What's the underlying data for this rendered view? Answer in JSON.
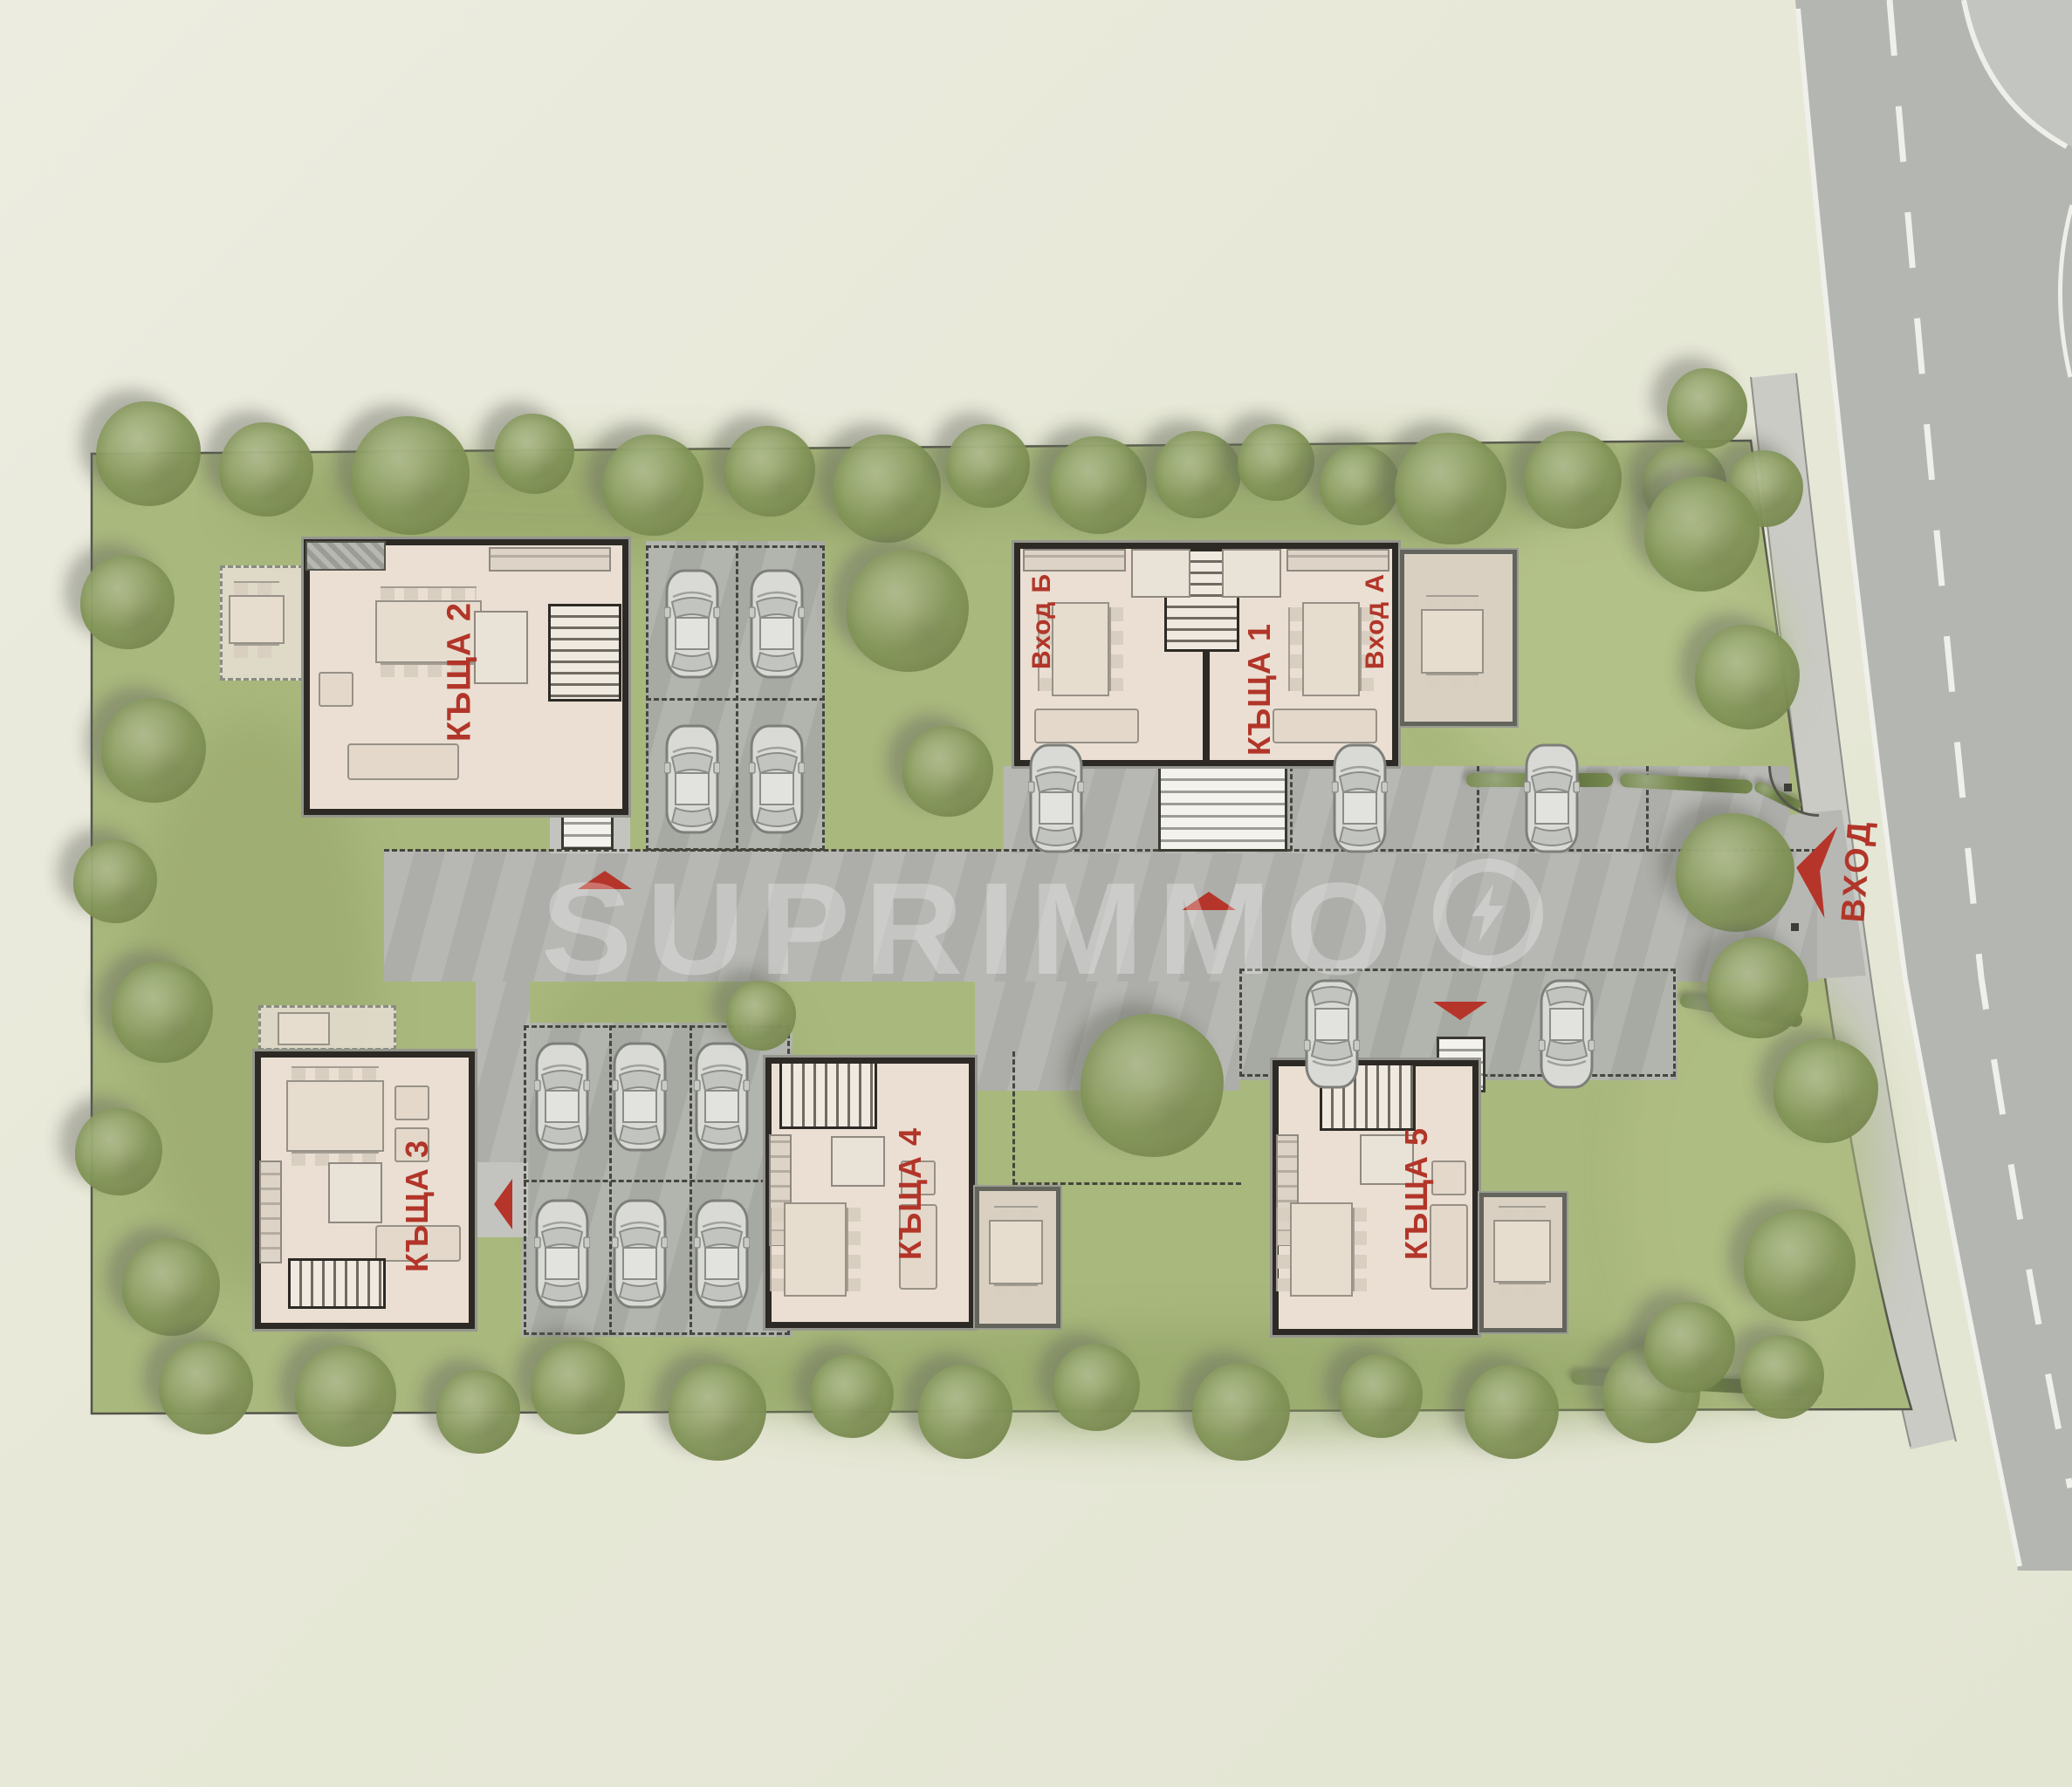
{
  "watermark": {
    "text": "SUPRIMMO"
  },
  "entrance": {
    "label": "ВХОД"
  },
  "houses": {
    "house1": {
      "label": "КЪЩА 1",
      "entrance_a": {
        "label": "Вход А"
      },
      "entrance_b": {
        "label": "Вход Б"
      }
    },
    "house2": {
      "label": "КЪЩА 2"
    },
    "house3": {
      "label": "КЪЩА 3"
    },
    "house4": {
      "label": "КЪЩА 4"
    },
    "house5": {
      "label": "КЪЩА 5"
    }
  },
  "colors": {
    "accent_red": "#b5352a",
    "grass_green": "#a9b87d",
    "road_gray": "#b4b6b2",
    "floor_cream": "#eadfd2",
    "wall_dark": "#2d2a25"
  }
}
